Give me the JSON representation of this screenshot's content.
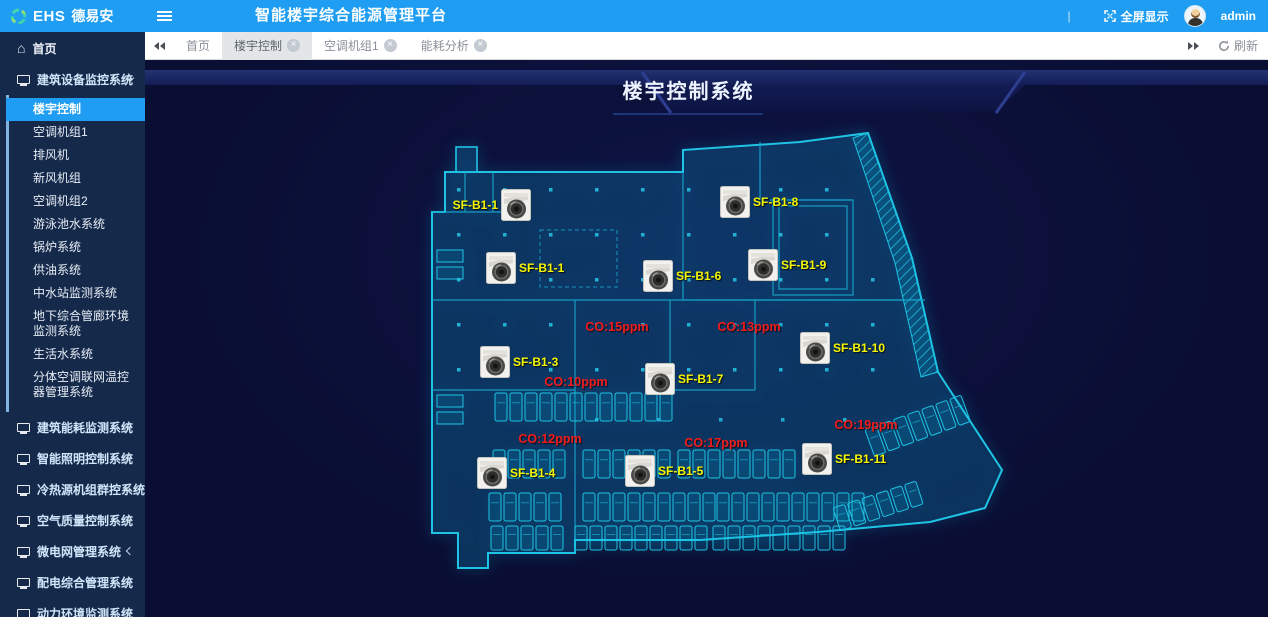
{
  "header": {
    "brand": "EHS",
    "brand_cn": "德易安",
    "title": "智能楼宇综合能源管理平台",
    "divider": "|",
    "fullscreen_label": "全屏显示",
    "username": "admin"
  },
  "tabbar": {
    "tabs": [
      {
        "label": "首页",
        "closable": false,
        "active": false
      },
      {
        "label": "楼宇控制",
        "closable": true,
        "active": true
      },
      {
        "label": "空调机组1",
        "closable": true,
        "active": false
      },
      {
        "label": "能耗分析",
        "closable": true,
        "active": false
      }
    ],
    "refresh_label": "刷新"
  },
  "sidebar": {
    "home_label": "首页",
    "device_group": {
      "label": "建筑设备监控系统",
      "expanded": true,
      "children": [
        {
          "label": "楼宇控制",
          "active": true
        },
        {
          "label": "空调机组1",
          "active": false
        },
        {
          "label": "排风机",
          "active": false
        },
        {
          "label": "新风机组",
          "active": false
        },
        {
          "label": "空调机组2",
          "active": false
        },
        {
          "label": "游泳池水系统",
          "active": false
        },
        {
          "label": "锅炉系统",
          "active": false
        },
        {
          "label": "供油系统",
          "active": false
        },
        {
          "label": "中水站监测系统",
          "active": false
        },
        {
          "label": "地下综合管廊环境监测系统",
          "active": false
        },
        {
          "label": "生活水系统",
          "active": false
        },
        {
          "label": "分体空调联网温控器管理系统",
          "active": false
        }
      ]
    },
    "collapsed_groups": [
      {
        "label": "建筑能耗监测系统"
      },
      {
        "label": "智能照明控制系统"
      },
      {
        "label": "冷热源机组群控系统"
      },
      {
        "label": "空气质量控制系统"
      },
      {
        "label": "微电网管理系统"
      },
      {
        "label": "配电综合管理系统"
      },
      {
        "label": "动力环境监测系统"
      }
    ]
  },
  "main": {
    "page_title": "楼宇控制系统",
    "floorplan": {
      "devices": [
        {
          "label": "SF-B1-1",
          "x": 91,
          "y": 75,
          "side": "left"
        },
        {
          "label": "SF-B1-8",
          "x": 310,
          "y": 72,
          "side": "right"
        },
        {
          "label": "SF-B1-1",
          "x": 76,
          "y": 138,
          "side": "right"
        },
        {
          "label": "SF-B1-6",
          "x": 233,
          "y": 146,
          "side": "right"
        },
        {
          "label": "SF-B1-9",
          "x": 338,
          "y": 135,
          "side": "right"
        },
        {
          "label": "SF-B1-10",
          "x": 390,
          "y": 218,
          "side": "right"
        },
        {
          "label": "SF-B1-3",
          "x": 70,
          "y": 232,
          "side": "right"
        },
        {
          "label": "SF-B1-7",
          "x": 235,
          "y": 249,
          "side": "right"
        },
        {
          "label": "SF-B1-4",
          "x": 67,
          "y": 343,
          "side": "right"
        },
        {
          "label": "SF-B1-5",
          "x": 215,
          "y": 341,
          "side": "right"
        },
        {
          "label": "SF-B1-11",
          "x": 392,
          "y": 329,
          "side": "right"
        }
      ],
      "co_readings": [
        {
          "text": "CO:15ppm",
          "x": 192,
          "y": 197
        },
        {
          "text": "CO:13ppm",
          "x": 324,
          "y": 197
        },
        {
          "text": "CO:10ppm",
          "x": 151,
          "y": 252
        },
        {
          "text": "CO:12ppm",
          "x": 125,
          "y": 309
        },
        {
          "text": "CO:17ppm",
          "x": 291,
          "y": 313
        },
        {
          "text": "CO:19ppm",
          "x": 441,
          "y": 295
        }
      ]
    }
  },
  "icons": {
    "logo": "ring-segments-icon",
    "menu": "hamburger-icon",
    "fullscreen": "expand-icon",
    "user": "avatar",
    "home": "home-icon",
    "group": "monitor-icon",
    "expand_chevron": "chevron-down-icon",
    "collapsed_chevron": "chevron-left-icon",
    "tab_back": "double-left-arrows-icon",
    "tab_forward": "double-right-arrows-icon",
    "refresh": "refresh-icon",
    "tab_close": "close-icon",
    "device": "fan-unit-icon"
  },
  "colors": {
    "header_blue": "#1e9df2",
    "sidebar_bg": "#15294b",
    "content_bg": "#0a0e33",
    "plan_cyan": "#1fc4e4",
    "device_label_yellow": "#f6f600",
    "co_red": "#f31c1c",
    "active_tab_bg": "#e3e6e9"
  }
}
